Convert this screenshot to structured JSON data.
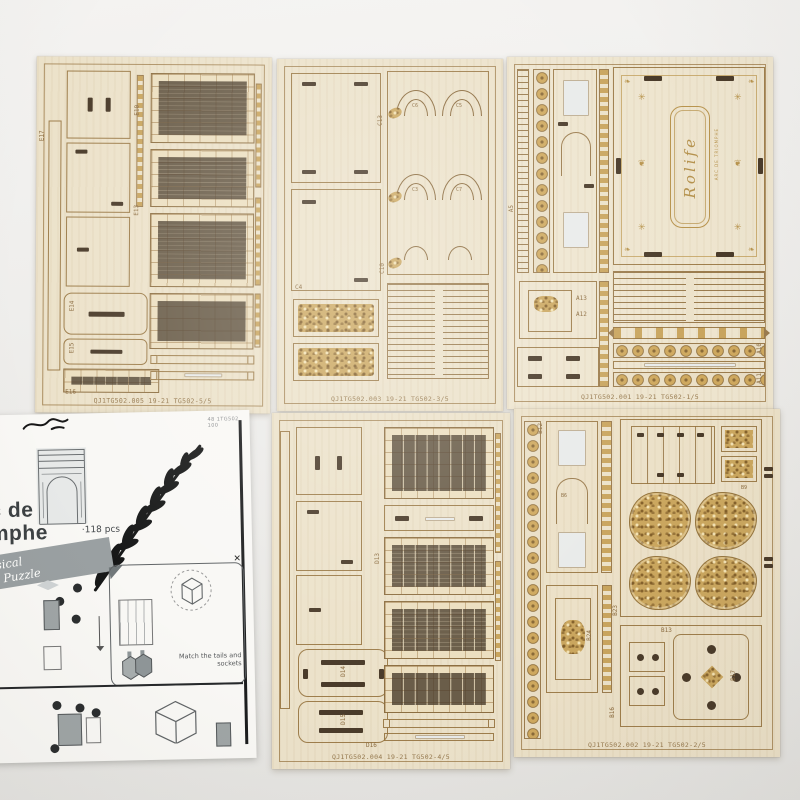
{
  "colors": {
    "background": "#edecea",
    "wood_base": "#ece2ca",
    "engrave_line": "#9b7c4e",
    "gold": "#c9a55e",
    "slot_dark": "#4a3b2a",
    "paper": "#f9f8f5"
  },
  "brand": {
    "engraving": "Rolife",
    "engraving_subtext": "ARC DE TRIOMPHE"
  },
  "sheets": {
    "top_left": {
      "code": "QJ1TG502.005 19-21 TG502-5/5",
      "labels": [
        "E17",
        "E10",
        "E13",
        "E14",
        "E15",
        "E16"
      ]
    },
    "top_middle": {
      "code": "QJ1TG502.003 19-21 TG502-3/5",
      "labels": [
        "C13",
        "C4",
        "C10",
        "C6",
        "C5",
        "C3",
        "C7"
      ]
    },
    "top_right": {
      "code": "QJ1TG502.001 19-21 TG502-1/5",
      "labels": [
        "A5",
        "A13",
        "A12",
        "A10",
        "A11"
      ]
    },
    "bottom_middle": {
      "code": "QJ1TG502.004 19-21 TG502-4/5",
      "labels": [
        "D16",
        "D13",
        "D14",
        "D15"
      ]
    },
    "bottom_right": {
      "code": "QJ1TG502.002 19-21 TG502-2/5",
      "labels": [
        "B12",
        "B6",
        "B24",
        "B23",
        "B9",
        "B13",
        "B17",
        "B16"
      ]
    }
  },
  "manual": {
    "corner_code": "48 1TG502 100",
    "title_fragment_line1": "c de",
    "title_fragment_line2": "mphe",
    "piece_count": "·118 pcs",
    "ribbon_fragment_line1": "ssical",
    "ribbon_fragment_line2": "den Puzzle",
    "instruction_text": "Match the tails and sockets"
  }
}
